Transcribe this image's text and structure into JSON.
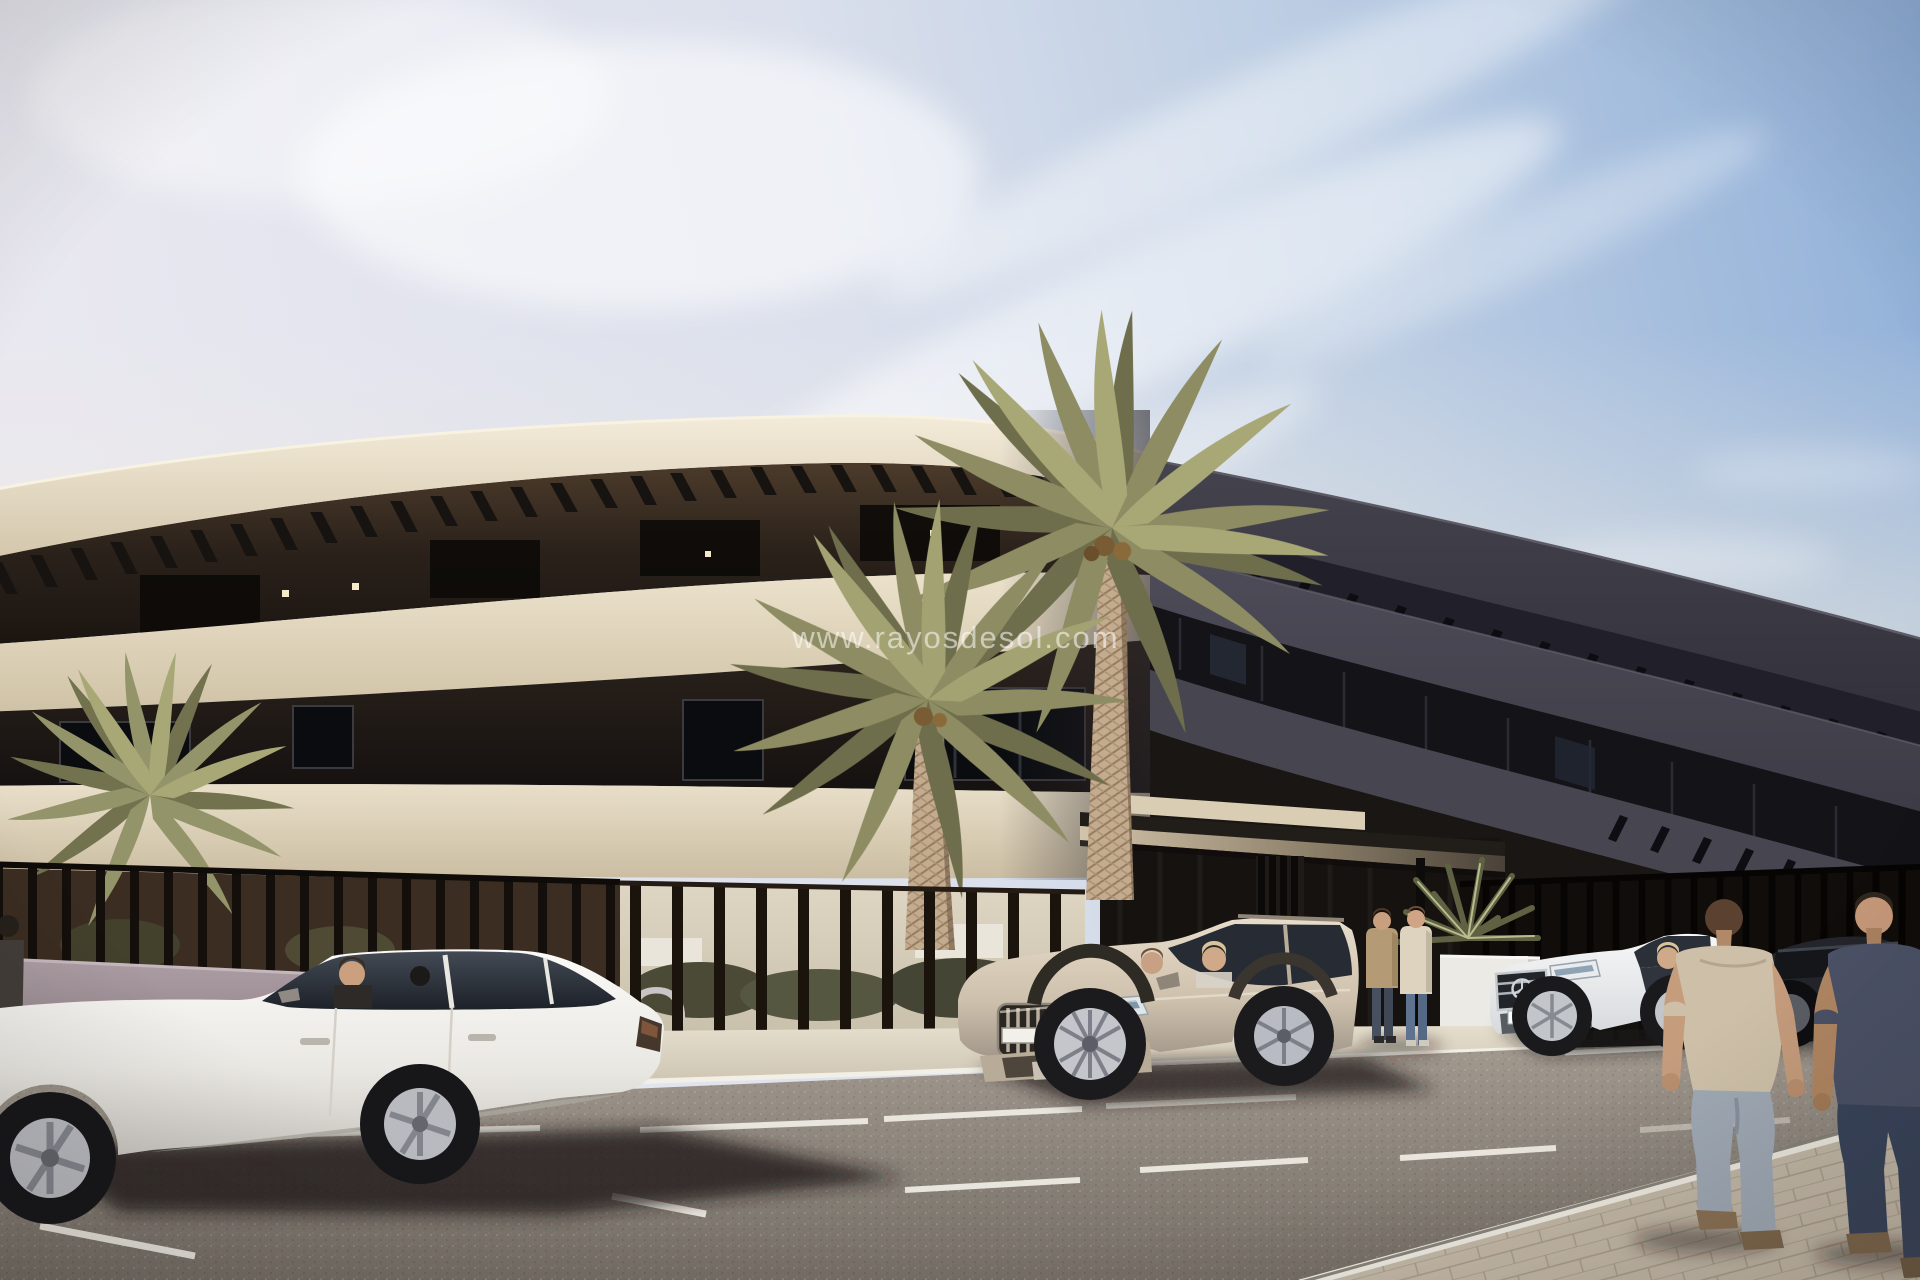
{
  "image": {
    "kind": "architectural-render-photo",
    "width_px": 1920,
    "height_px": 1280
  },
  "watermark": {
    "text": "www.rayosdesol.com",
    "color": "#ffffff",
    "opacity": 0.55
  },
  "signage": {
    "wall_letters": "TO",
    "color": "#cac4c6"
  },
  "palette": {
    "sky_left": "#e8e7ef",
    "sky_right": "#8fafd8",
    "building_cream": "#e6dcc6",
    "building_dark_wing": "#3d3b44",
    "window_band_dark": "#15151a",
    "pergola_slat": "#171310",
    "fence_dark": "#17120d",
    "wall_mauve": "#a3949b",
    "entrance_canopy": "#cfc0a8",
    "road_asphalt": "#8d857c",
    "sidewalk": "#ddd5c6",
    "pavers": "#c3b8a7",
    "palm_green": "#8d8c62",
    "palm_trunk": "#c0a98d",
    "sedan_white": "#f0eeea",
    "suv_champagne": "#cfc3b0",
    "mercedes_white": "#eef0f2",
    "dark_sedan": "#23252a"
  },
  "scene": {
    "objects": [
      "sky with cirrus clouds",
      "curved apartment building, sunlit cream wing and shaded dark wing",
      "rooftop pergola slats",
      "entrance canopy with slatted pillar",
      "privacy slat fence over mauve wall with partial project lettering",
      "two large palm trees, small palm, yucca",
      "white sedan with driver",
      "champagne SUV with two occupants",
      "white mercedes sedan with driver",
      "dark sedan",
      "couple standing at entrance",
      "two men walking away on right sidewalk",
      "partial pedestrian at left edge",
      "asphalt road with white parking lines",
      "paver sidewalk bottom right"
    ]
  }
}
